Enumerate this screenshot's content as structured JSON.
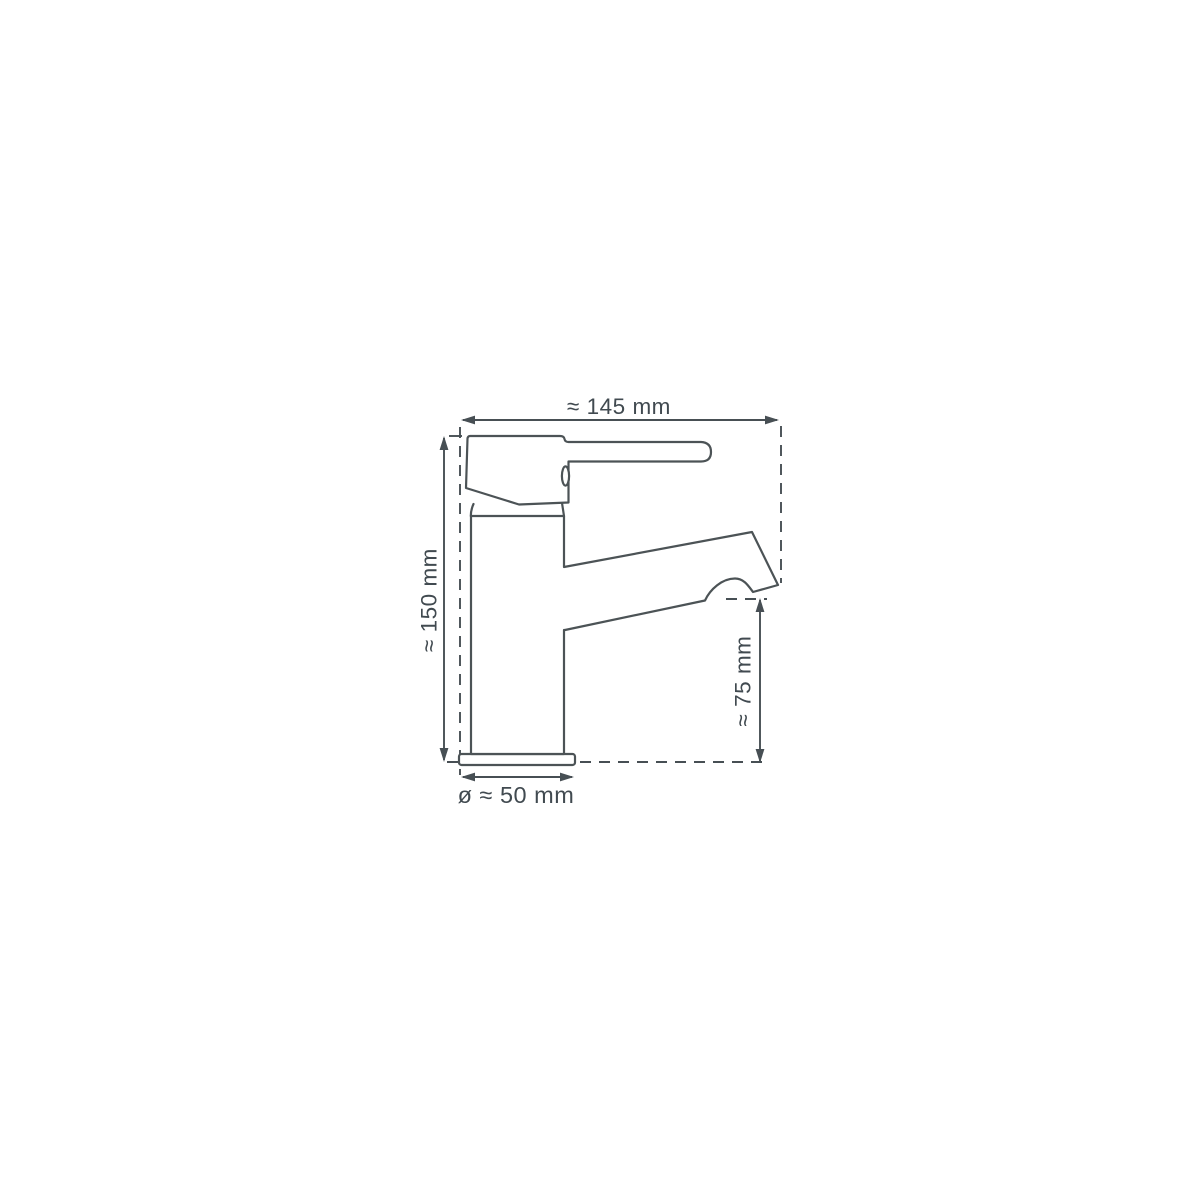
{
  "page": {
    "background": "#ffffff"
  },
  "diagram": {
    "type": "technical-dimension-drawing",
    "subject": "single-lever basin mixer tap, side view",
    "colors": {
      "line": "#4c5356",
      "dimension_line": "#474f54",
      "text": "#414a50",
      "background": "#ffffff"
    },
    "dimensions": {
      "width": {
        "label": "≈ 145 mm",
        "value": 145,
        "unit": "mm",
        "approx": true,
        "orientation": "horizontal",
        "position": "top"
      },
      "height": {
        "label": "≈ 150 mm",
        "value": 150,
        "unit": "mm",
        "approx": true,
        "orientation": "vertical",
        "position": "left"
      },
      "spout_height": {
        "label": "≈ 75 mm",
        "value": 75,
        "unit": "mm",
        "approx": true,
        "orientation": "vertical",
        "position": "right"
      },
      "base_diameter": {
        "label": "ø ≈ 50 mm",
        "value": 50,
        "unit": "mm",
        "approx": true,
        "orientation": "horizontal",
        "position": "bottom"
      }
    }
  }
}
